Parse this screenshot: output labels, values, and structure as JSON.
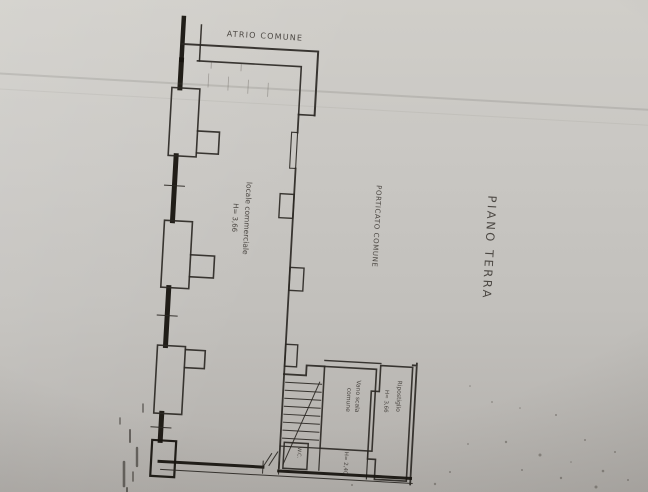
{
  "photo": {
    "paper_color": "#c7c5c1",
    "ink_color": "#2b2824"
  },
  "plan": {
    "title": "PIANO TERRA",
    "labels": {
      "atrio": "ATRIO COMUNE",
      "locale_commerciale": "locale commerciale",
      "locale_commerciale_height": "H= 3,66",
      "porticato": "PORTICATO COMUNE",
      "vano_scala_line1": "Vano scala",
      "vano_scala_line2": "comune",
      "ripostiglio": "Ripostiglio",
      "ripostiglio_height": "H= 3,66",
      "sottoscala_height": "H= 2,40",
      "wc": "W.C."
    }
  }
}
